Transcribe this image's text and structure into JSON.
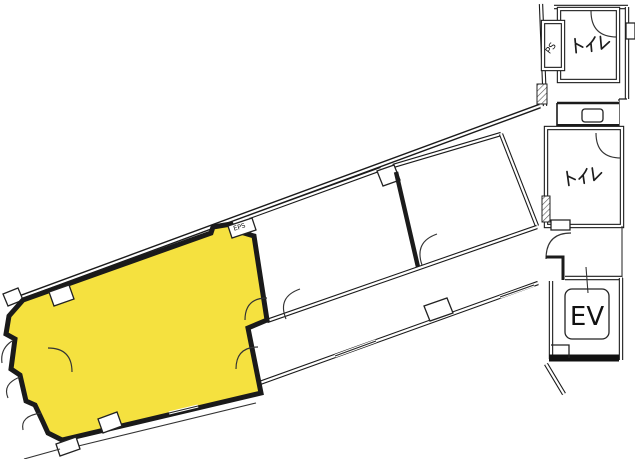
{
  "plan": {
    "type": "floor-plan",
    "highlighted_room_present": true
  },
  "labels": {
    "toilet_upper": "トイレ",
    "toilet_lower": "トイレ",
    "pipe_space": "PS",
    "eps": "EPS",
    "elevator": "EV"
  },
  "colors": {
    "highlight": "#F5E13F",
    "wall": "#1C1C1C",
    "floor": "#FFFFFF"
  }
}
